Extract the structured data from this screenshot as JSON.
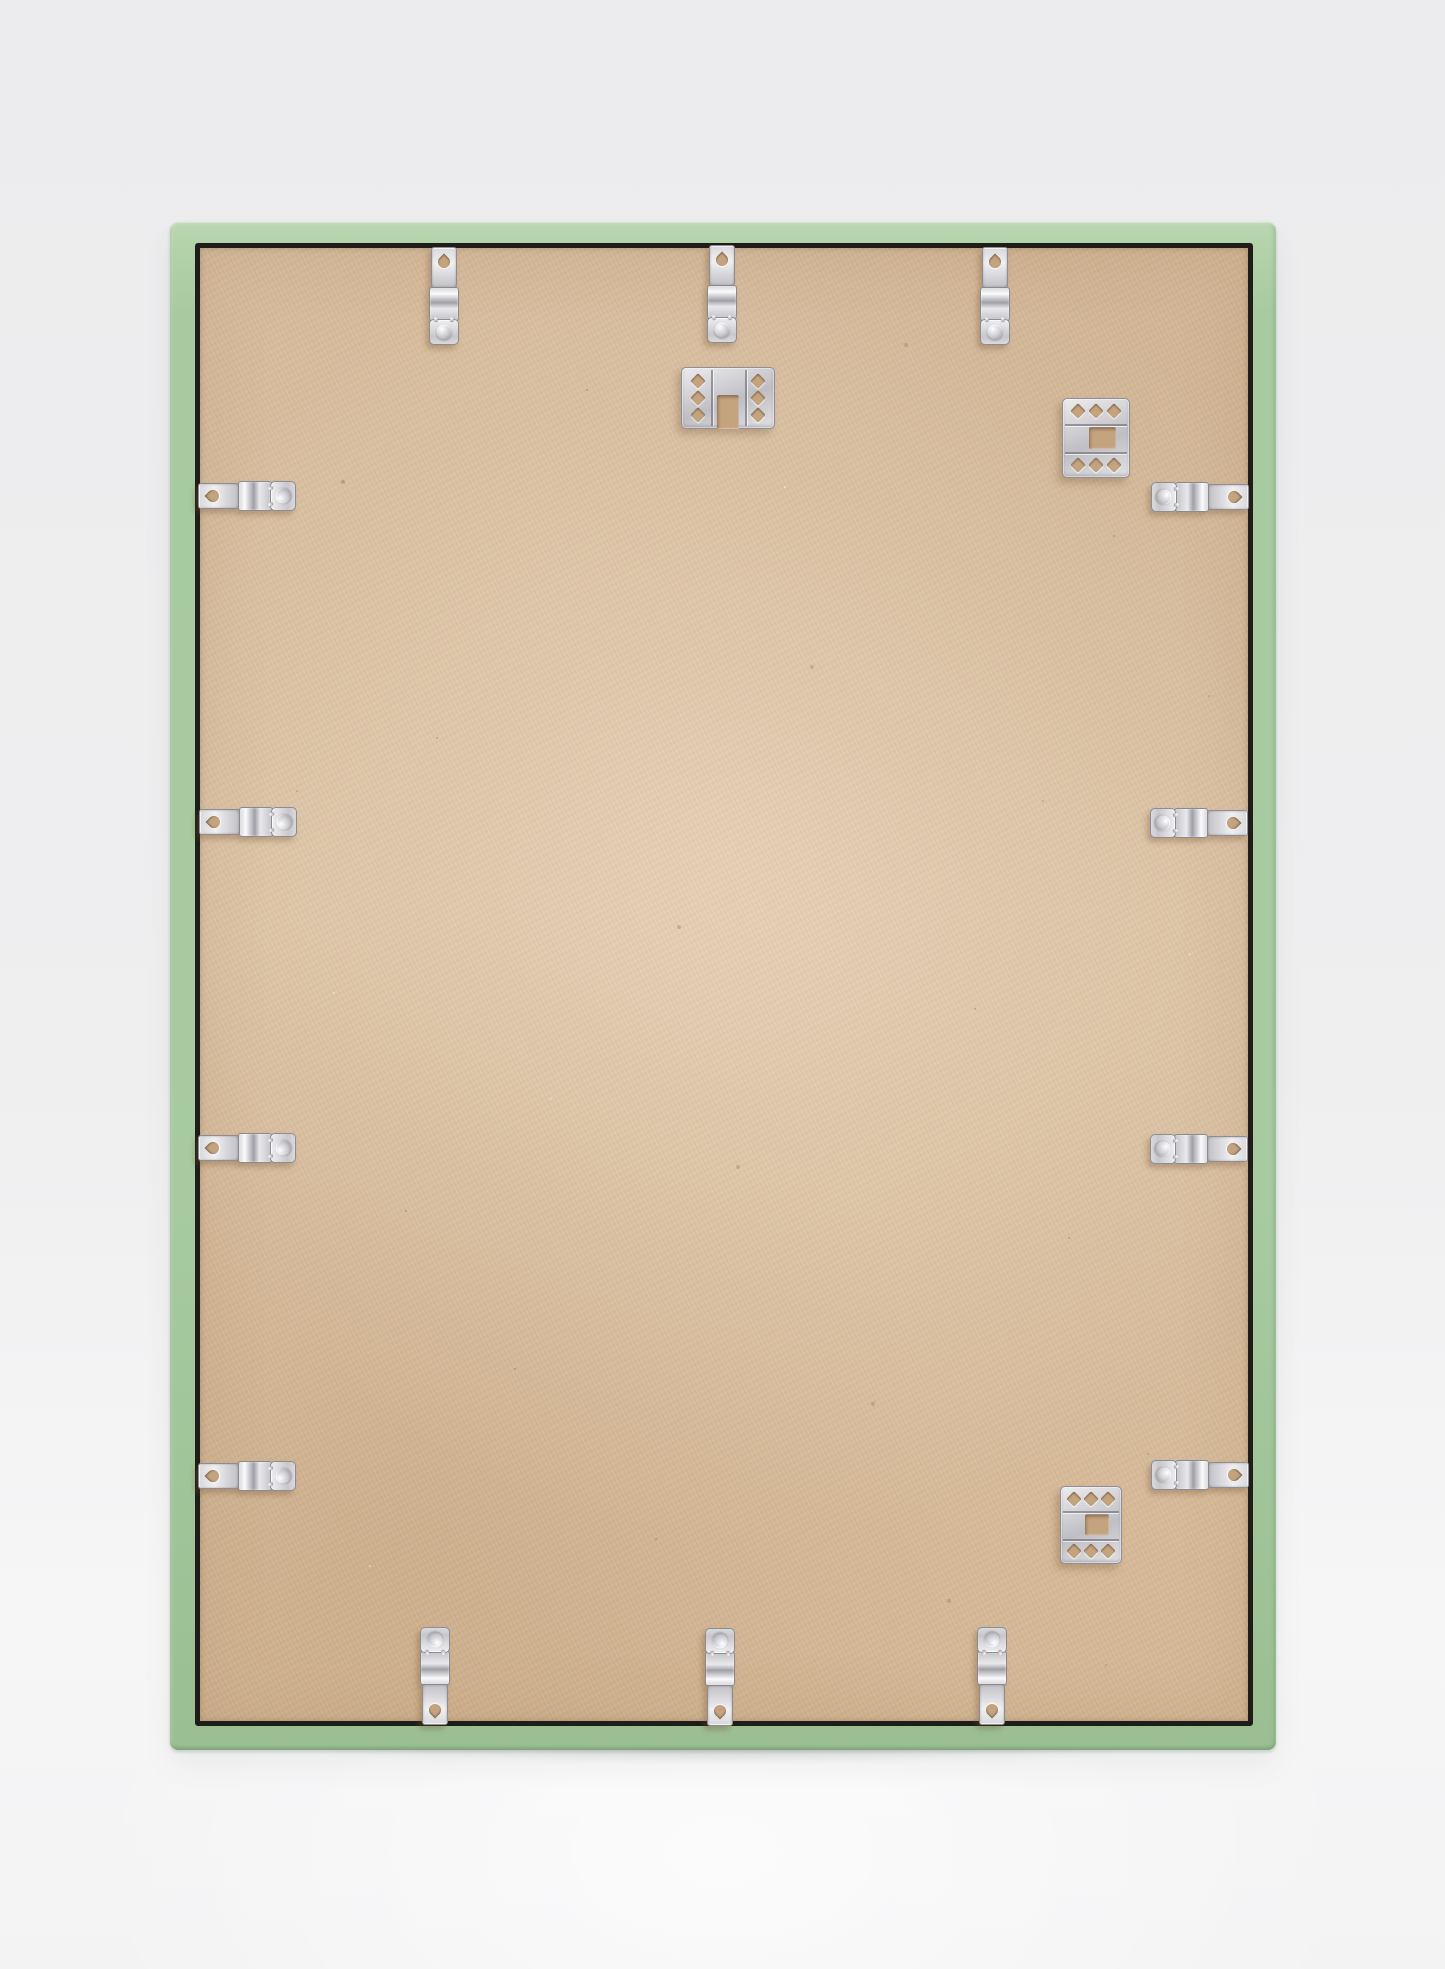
{
  "scene": {
    "subject": "back-of-picture-frame",
    "description": "Empty wooden picture frame standing upright, seen from the back: sage green moulding, kraft MDF backing board, metal spring clips around the perimeter and punched-steel hanger plates",
    "frame_color_name": "sage-green",
    "backing_material": "mdf-kraft-board",
    "hardware_finish": "nickel-silver"
  },
  "colors": {
    "frame_green": "#a7caa0",
    "frame_green_light": "#b8d6af",
    "frame_green_deep": "#9bbf93",
    "backing_tan": "#d9bd9e",
    "seam_dark": "#1f1d19",
    "hole_tan": "#c4a37f",
    "background_gray": "#efeff0",
    "metal_light": "#f0f0f3",
    "metal_mid": "#c3c3c9",
    "metal_dark": "#8d8d93"
  },
  "frame": {
    "outer": {
      "x": 170,
      "y": 222,
      "w": 1106,
      "h": 1528
    },
    "backing": {
      "x": 25,
      "y": 21,
      "w": 1058,
      "h": 1483
    },
    "floor_shadow": {
      "x": 160,
      "y": 1744,
      "w": 1126,
      "h": 24
    }
  },
  "hardware": {
    "clip_count": 14,
    "hanger_count": 3,
    "clips": [
      {
        "x": 444,
        "y": 295,
        "rot": 0,
        "side": "top"
      },
      {
        "x": 722,
        "y": 293,
        "rot": 0,
        "side": "top"
      },
      {
        "x": 995,
        "y": 295,
        "rot": 0,
        "side": "top"
      },
      {
        "x": 1201,
        "y": 497,
        "rot": 90,
        "side": "right"
      },
      {
        "x": 1200,
        "y": 823,
        "rot": 90,
        "side": "right"
      },
      {
        "x": 1200,
        "y": 1149,
        "rot": 90,
        "side": "right"
      },
      {
        "x": 1201,
        "y": 1475,
        "rot": 90,
        "side": "right"
      },
      {
        "x": 992,
        "y": 1677,
        "rot": 180,
        "side": "bottom"
      },
      {
        "x": 720,
        "y": 1678,
        "rot": 180,
        "side": "bottom"
      },
      {
        "x": 435,
        "y": 1677,
        "rot": 180,
        "side": "bottom"
      },
      {
        "x": 246,
        "y": 1476,
        "rot": -90,
        "side": "left"
      },
      {
        "x": 246,
        "y": 1148,
        "rot": -90,
        "side": "left"
      },
      {
        "x": 247,
        "y": 822,
        "rot": -90,
        "side": "left"
      },
      {
        "x": 246,
        "y": 496,
        "rot": -90,
        "side": "left"
      }
    ],
    "hangers": [
      {
        "x": 728,
        "y": 398,
        "w": 92,
        "h": 60,
        "orient": "down",
        "position": "top-center"
      },
      {
        "x": 1096,
        "y": 438,
        "w": 66,
        "h": 78,
        "orient": "right",
        "position": "top-right"
      },
      {
        "x": 1091,
        "y": 1525,
        "w": 60,
        "h": 76,
        "orient": "right",
        "position": "bottom-right"
      }
    ]
  }
}
